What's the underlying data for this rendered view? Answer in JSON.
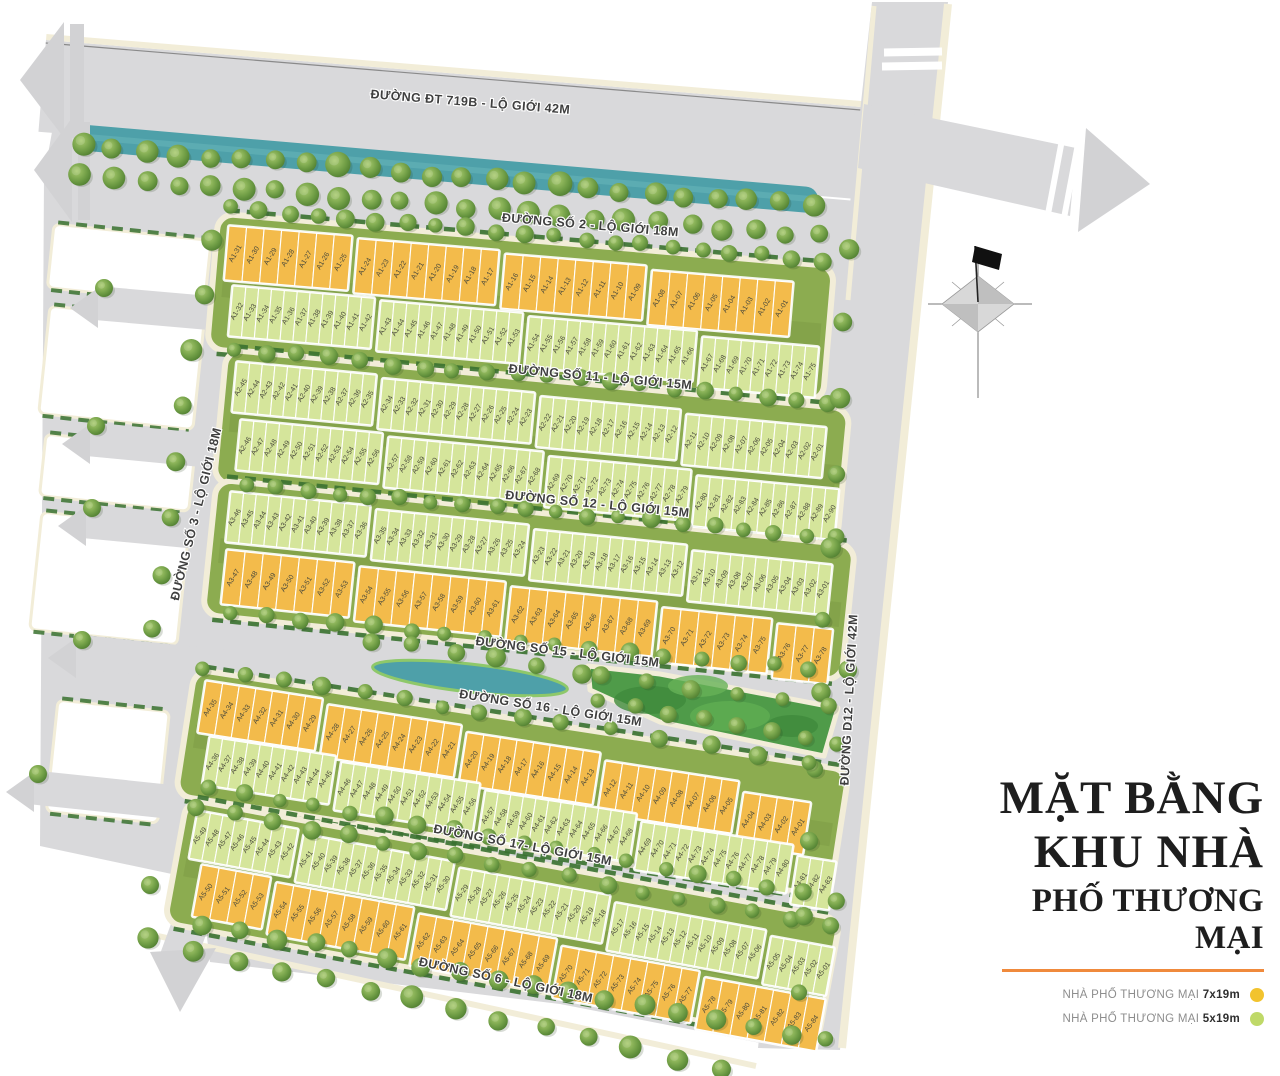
{
  "title": {
    "lines": [
      "MẶT BẰNG",
      "KHU NHÀ",
      "PHỐ THƯƠNG MẠI"
    ]
  },
  "legend": {
    "items": [
      {
        "label": "NHÀ PHỐ THƯƠNG MẠI",
        "size": "7x19m",
        "color": "#F2C32E"
      },
      {
        "label": "NHÀ PHỐ THƯƠNG MẠI",
        "size": "5x19m",
        "color": "#BFD968"
      }
    ]
  },
  "roads": [
    {
      "id": "dt719b",
      "label": "ĐƯỜNG ĐT 719B - LỘ GIỚI 42M"
    },
    {
      "id": "so2",
      "label": "ĐƯỜNG SỐ 2 - LỘ GIỚI 18M"
    },
    {
      "id": "so11",
      "label": "ĐƯỜNG SỐ 11 - LỘ GIỚI 15M"
    },
    {
      "id": "so12",
      "label": "ĐƯỜNG SỐ 12 - LỘ GIỚI 15M"
    },
    {
      "id": "so15",
      "label": "ĐƯỜNG SỐ 15 - LỘ GIỚI 15M"
    },
    {
      "id": "so16",
      "label": "ĐƯỜNG SỐ 16 - LỘ GIỚI 15M"
    },
    {
      "id": "so17",
      "label": "ĐƯỜNG SỐ 17- LỘ GIỚI 15M"
    },
    {
      "id": "so6",
      "label": "ĐƯỜNG SỐ 6 - LỘ GIỚI 18M"
    },
    {
      "id": "so3",
      "label": "ĐƯỜNG SỐ 3 - LỘ GIỚI 18M"
    },
    {
      "id": "d12",
      "label": "ĐƯỜNG D12 - LỘ GIỚI 42M"
    }
  ],
  "zones": {
    "rows": [
      {
        "id": "a1f",
        "type": "7x19m",
        "blocks": [
          [
            "A1-31",
            "A1-30",
            "A1-29",
            "A1-28",
            "A1-27",
            "A1-26",
            "A1-25"
          ],
          [
            "A1-24",
            "A1-23",
            "A1-22",
            "A1-21",
            "A1-20",
            "A1-19",
            "A1-18",
            "A1-17"
          ],
          [
            "A1-16",
            "A1-15",
            "A1-14",
            "A1-13",
            "A1-12",
            "A1-11",
            "A1-10",
            "A1-09"
          ],
          [
            "A1-08",
            "A1-07",
            "A1-06",
            "A1-05",
            "A1-04",
            "A1-03",
            "A1-02",
            "A1-01"
          ]
        ]
      },
      {
        "id": "a1b",
        "type": "5x19m",
        "blocks": [
          [
            "A1-32",
            "A1-33",
            "A1-34",
            "A1-35",
            "A1-36",
            "A1-37",
            "A1-38",
            "A1-39",
            "A1-40",
            "A1-41",
            "A1-42"
          ],
          [
            "A1-43",
            "A1-44",
            "A1-45",
            "A1-46",
            "A1-47",
            "A1-48",
            "A1-49",
            "A1-50",
            "A1-51",
            "A1-52",
            "A1-53"
          ],
          [
            "A1-54",
            "A1-55",
            "A1-56",
            "A1-57",
            "A1-58",
            "A1-59",
            "A1-60",
            "A1-61",
            "A1-62",
            "A1-63",
            "A1-64",
            "A1-65",
            "A1-66"
          ],
          [
            "A1-67",
            "A1-68",
            "A1-69",
            "A1-70",
            "A1-71",
            "A1-72",
            "A1-73",
            "A1-74",
            "A1-75"
          ]
        ]
      },
      {
        "id": "a2f",
        "type": "5x19m",
        "blocks": [
          [
            "A2-45",
            "A2-44",
            "A2-43",
            "A2-42",
            "A2-41",
            "A2-40",
            "A2-39",
            "A2-38",
            "A2-37",
            "A2-36",
            "A2-35"
          ],
          [
            "A2-34",
            "A2-33",
            "A2-32",
            "A2-31",
            "A2-30",
            "A2-29",
            "A2-28",
            "A2-27",
            "A2-26",
            "A2-25",
            "A2-24",
            "A2-23"
          ],
          [
            "A2-22",
            "A2-21",
            "A2-20",
            "A2-19",
            "A2-18",
            "A2-17",
            "A2-16",
            "A2-15",
            "A2-14",
            "A2-13",
            "A2-12"
          ],
          [
            "A2-11",
            "A2-10",
            "A2-09",
            "A2-08",
            "A2-07",
            "A2-06",
            "A2-05",
            "A2-04",
            "A2-03",
            "A2-02",
            "A2-01"
          ]
        ]
      },
      {
        "id": "a2b",
        "type": "5x19m",
        "blocks": [
          [
            "A2-46",
            "A2-47",
            "A2-48",
            "A2-49",
            "A2-50",
            "A2-51",
            "A2-52",
            "A2-53",
            "A2-54",
            "A2-55",
            "A2-56"
          ],
          [
            "A2-57",
            "A2-58",
            "A2-59",
            "A2-60",
            "A2-61",
            "A2-62",
            "A2-63",
            "A2-64",
            "A2-65",
            "A2-66",
            "A2-67",
            "A2-68"
          ],
          [
            "A2-69",
            "A2-70",
            "A2-71",
            "A2-72",
            "A2-73",
            "A2-74",
            "A2-75",
            "A2-76",
            "A2-77",
            "A2-78",
            "A2-79"
          ],
          [
            "A2-80",
            "A2-81",
            "A2-82",
            "A2-83",
            "A2-84",
            "A2-85",
            "A2-86",
            "A2-87",
            "A2-88",
            "A2-89",
            "A2-90"
          ]
        ]
      },
      {
        "id": "a3f",
        "type": "5x19m",
        "blocks": [
          [
            "A3-46",
            "A3-45",
            "A3-44",
            "A3-43",
            "A3-42",
            "A3-41",
            "A3-40",
            "A3-39",
            "A3-38",
            "A3-37",
            "A3-36"
          ],
          [
            "A3-35",
            "A3-34",
            "A3-33",
            "A3-32",
            "A3-31",
            "A3-30",
            "A3-29",
            "A3-28",
            "A3-27",
            "A3-26",
            "A3-25",
            "A3-24"
          ],
          [
            "A3-23",
            "A3-22",
            "A3-21",
            "A3-20",
            "A3-19",
            "A3-18",
            "A3-17",
            "A3-16",
            "A3-15",
            "A3-14",
            "A3-13",
            "A3-12"
          ],
          [
            "A3-11",
            "A3-10",
            "A3-09",
            "A3-08",
            "A3-07",
            "A3-06",
            "A3-05",
            "A3-04",
            "A3-03",
            "A3-02",
            "A3-01"
          ]
        ]
      },
      {
        "id": "a3b",
        "type": "7x19m",
        "blocks": [
          [
            "A3-47",
            "A3-48",
            "A3-49",
            "A3-50",
            "A3-51",
            "A3-52",
            "A3-53"
          ],
          [
            "A3-54",
            "A3-55",
            "A3-56",
            "A3-57",
            "A3-58",
            "A3-59",
            "A3-60",
            "A3-61"
          ],
          [
            "A3-62",
            "A3-63",
            "A3-64",
            "A3-65",
            "A3-66",
            "A3-67",
            "A3-68",
            "A3-69"
          ],
          [
            "A3-70",
            "A3-71",
            "A3-72",
            "A3-73",
            "A3-74",
            "A3-75"
          ],
          [
            "A3-76",
            "A3-77",
            "A3-78"
          ]
        ]
      },
      {
        "id": "a4f",
        "type": "7x19m",
        "blocks": [
          [
            "A4-35",
            "A4-34",
            "A4-33",
            "A4-32",
            "A4-31",
            "A4-30",
            "A4-29"
          ],
          [
            "A4-28",
            "A4-27",
            "A4-26",
            "A4-25",
            "A4-24",
            "A4-23",
            "A4-22",
            "A4-21"
          ],
          [
            "A4-20",
            "A4-19",
            "A4-18",
            "A4-17",
            "A4-16",
            "A4-15",
            "A4-14",
            "A4-13"
          ],
          [
            "A4-12",
            "A4-11",
            "A4-10",
            "A4-09",
            "A4-08",
            "A4-07",
            "A4-06",
            "A4-05"
          ],
          [
            "A4-04",
            "A4-03",
            "A4-02",
            "A4-01"
          ]
        ]
      },
      {
        "id": "a4b",
        "type": "5x19m",
        "blocks": [
          [
            "A4-36",
            "A4-37",
            "A4-38",
            "A4-39",
            "A4-40",
            "A4-41",
            "A4-42",
            "A4-43",
            "A4-44",
            "A4-45"
          ],
          [
            "A4-46",
            "A4-47",
            "A4-48",
            "A4-49",
            "A4-50",
            "A4-51",
            "A4-52",
            "A4-53",
            "A4-54",
            "A4-55",
            "A4-56"
          ],
          [
            "A4-57",
            "A4-58",
            "A4-59",
            "A4-60",
            "A4-61",
            "A4-62",
            "A4-63",
            "A4-64",
            "A4-65",
            "A4-66",
            "A4-67",
            "A4-68"
          ],
          [
            "A4-69",
            "A4-70",
            "A4-71",
            "A4-72",
            "A4-73",
            "A4-74",
            "A4-75",
            "A4-76",
            "A4-77",
            "A4-78",
            "A4-79",
            "A4-80"
          ],
          [
            "A4-81",
            "A4-82",
            "A4-83"
          ]
        ]
      },
      {
        "id": "a5f",
        "type": "5x19m",
        "blocks": [
          [
            "A5-49",
            "A5-48",
            "A5-47",
            "A5-46",
            "A5-45",
            "A5-44",
            "A5-43",
            "A5-42"
          ],
          [
            "A5-41",
            "A5-40",
            "A5-39",
            "A5-38",
            "A5-37",
            "A5-36",
            "A5-35",
            "A5-34",
            "A5-33",
            "A5-32",
            "A5-31",
            "A5-30"
          ],
          [
            "A5-29",
            "A5-28",
            "A5-27",
            "A5-26",
            "A5-25",
            "A5-24",
            "A5-23",
            "A5-22",
            "A5-21",
            "A5-20",
            "A5-19",
            "A5-18"
          ],
          [
            "A5-17",
            "A5-16",
            "A5-15",
            "A5-14",
            "A5-13",
            "A5-12",
            "A5-11",
            "A5-10",
            "A5-09",
            "A5-08",
            "A5-07",
            "A5-06"
          ],
          [
            "A5-05",
            "A5-04",
            "A5-03",
            "A5-02",
            "A5-01"
          ]
        ]
      },
      {
        "id": "a5b",
        "type": "7x19m",
        "blocks": [
          [
            "A5-50",
            "A5-51",
            "A5-52",
            "A5-53"
          ],
          [
            "A5-54",
            "A5-55",
            "A5-56",
            "A5-57",
            "A5-58",
            "A5-59",
            "A5-60",
            "A5-61"
          ],
          [
            "A5-62",
            "A5-63",
            "A5-64",
            "A5-65",
            "A5-66",
            "A5-67",
            "A5-68",
            "A5-69"
          ],
          [
            "A5-70",
            "A5-71",
            "A5-72",
            "A5-73",
            "A5-74",
            "A5-75",
            "A5-76",
            "A5-77"
          ],
          [
            "A5-78",
            "A5-79",
            "A5-80",
            "A5-81",
            "A5-82",
            "A5-83",
            "A5-84"
          ]
        ]
      }
    ]
  },
  "colors": {
    "lot_7x19": "#F3BB4B",
    "lot_5x19": "#D5E59B",
    "road": "#D9D9DB",
    "sidewalk": "#F2EDD8",
    "canal": "#4EA0A9",
    "grass": "#8CAC50",
    "hedge": "#3A7230",
    "park": "#4F9B49",
    "accent_line": "#F08A3C",
    "arrow": "#D2D2D4"
  }
}
